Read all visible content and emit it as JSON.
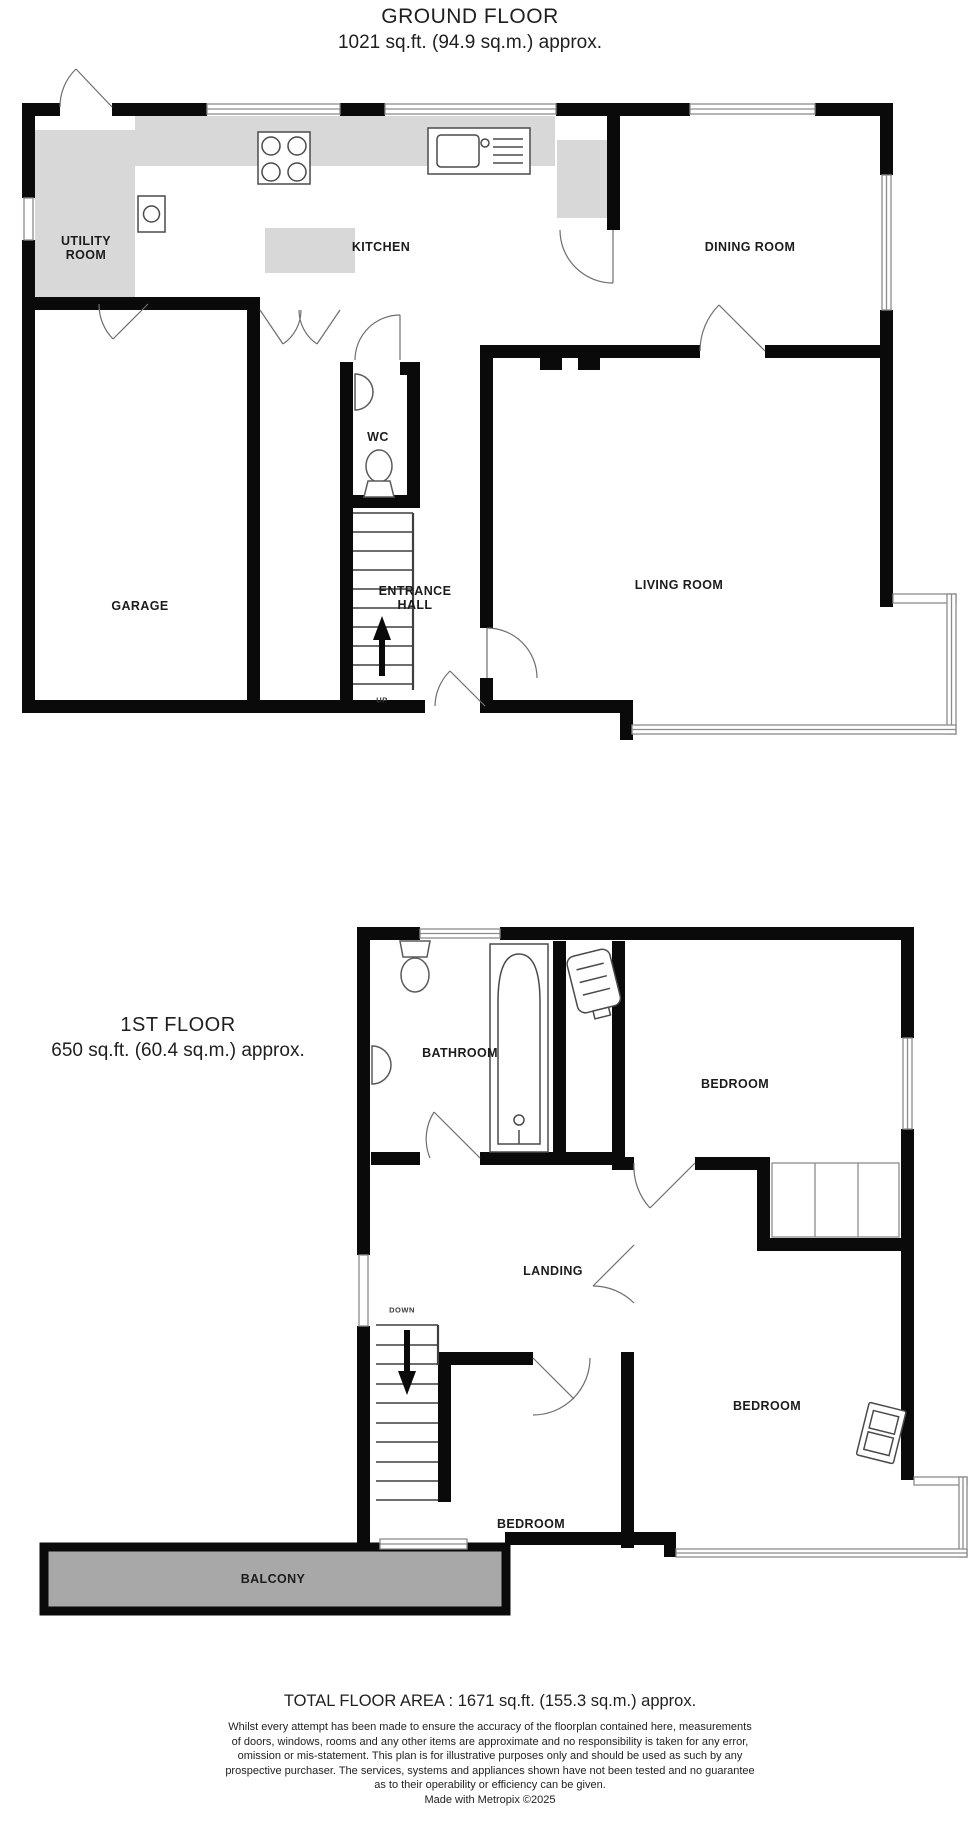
{
  "page": {
    "background_color": "#ffffff",
    "wall_color": "#0a0a0a",
    "worktop_color": "#d8d8d8",
    "balcony_fill": "#a8a8a8",
    "window_line_color": "#8c8c8c"
  },
  "ground_floor": {
    "title": "GROUND FLOOR",
    "area": "1021 sq.ft. (94.9 sq.m.) approx.",
    "labels": {
      "utility": "UTILITY\nROOM",
      "kitchen": "KITCHEN",
      "dining": "DINING ROOM",
      "wc": "WC",
      "entrance": "ENTRANCE\nHALL",
      "garage": "GARAGE",
      "living": "LIVING ROOM",
      "up": "UP"
    }
  },
  "first_floor": {
    "title": "1ST FLOOR",
    "area": "650 sq.ft. (60.4 sq.m.) approx.",
    "labels": {
      "bathroom": "BATHROOM",
      "bedroom_top": "BEDROOM",
      "landing": "LANDING",
      "down": "DOWN",
      "bedroom_right": "BEDROOM",
      "bedroom_middle": "BEDROOM",
      "balcony": "BALCONY"
    }
  },
  "footer": {
    "total_area": "TOTAL FLOOR AREA : 1671 sq.ft. (155.3 sq.m.) approx.",
    "disclaimer": "Whilst every attempt has been made to ensure the accuracy of the floorplan contained here, measurements\nof doors, windows, rooms and any other items are approximate and no responsibility is taken for any error,\nomission or mis-statement. This plan is for illustrative purposes only and should be used as such by any\nprospective purchaser. The services, systems and appliances shown have not been tested and no guarantee\nas to their operability or efficiency can be given.",
    "credit": "Made with Metropix ©2025"
  }
}
